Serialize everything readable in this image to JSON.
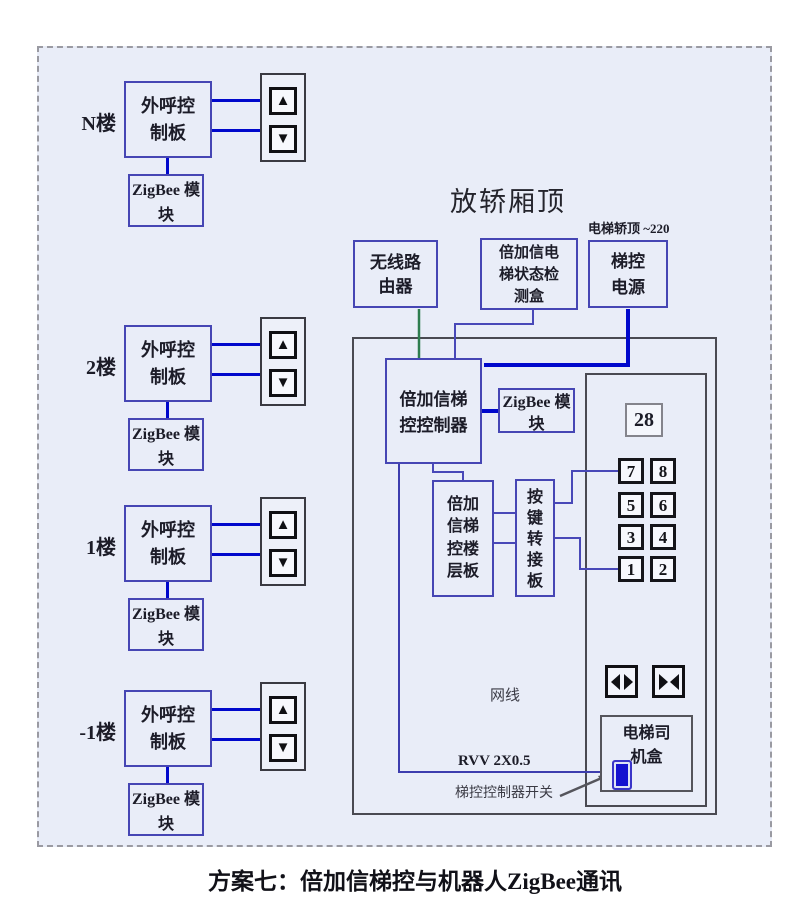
{
  "footer": {
    "title": "方案七：倍加信梯控与机器人ZigBee通讯"
  },
  "floors": [
    {
      "label": "N楼",
      "board": "外呼控制板",
      "zigbee": "ZigBee 模块"
    },
    {
      "label": "2楼",
      "board": "外呼控制板",
      "zigbee": "ZigBee 模块"
    },
    {
      "label": "1楼",
      "board": "外呼控制板",
      "zigbee": "ZigBee 模块"
    },
    {
      "label": "-1楼",
      "board": "外呼控制板",
      "zigbee": "ZigBee 模块"
    }
  ],
  "car_top": {
    "section_title": "放轿厢顶",
    "power_note": "电梯轿顶 ~220",
    "router": "无线路由器",
    "detector": "倍加信电梯状态检测盒",
    "power": "梯控电源",
    "controller": "倍加信梯控控制器",
    "zigbee": "ZigBee 模块",
    "floor_board": "倍加信梯控楼层板",
    "key_adapter": "按键转接板",
    "display": "28",
    "buttons": [
      "7",
      "8",
      "5",
      "6",
      "3",
      "4",
      "1",
      "2"
    ],
    "net_label": "网线",
    "rvv_label": "RVV 2X0.5",
    "switch_label": "梯控控制器开关",
    "driver_box": "电梯司机盒"
  },
  "icons": {
    "up_arrow": "▲",
    "down_arrow": "▼"
  },
  "colors": {
    "wire_thick_blue": "#0008cc",
    "wire_thin_blue": "#4848b8",
    "wire_green": "#2e7d4f",
    "box_border_blue": "#4646b4",
    "panel_bg": "#e9edf8",
    "switch_fill": "#1512d0"
  }
}
